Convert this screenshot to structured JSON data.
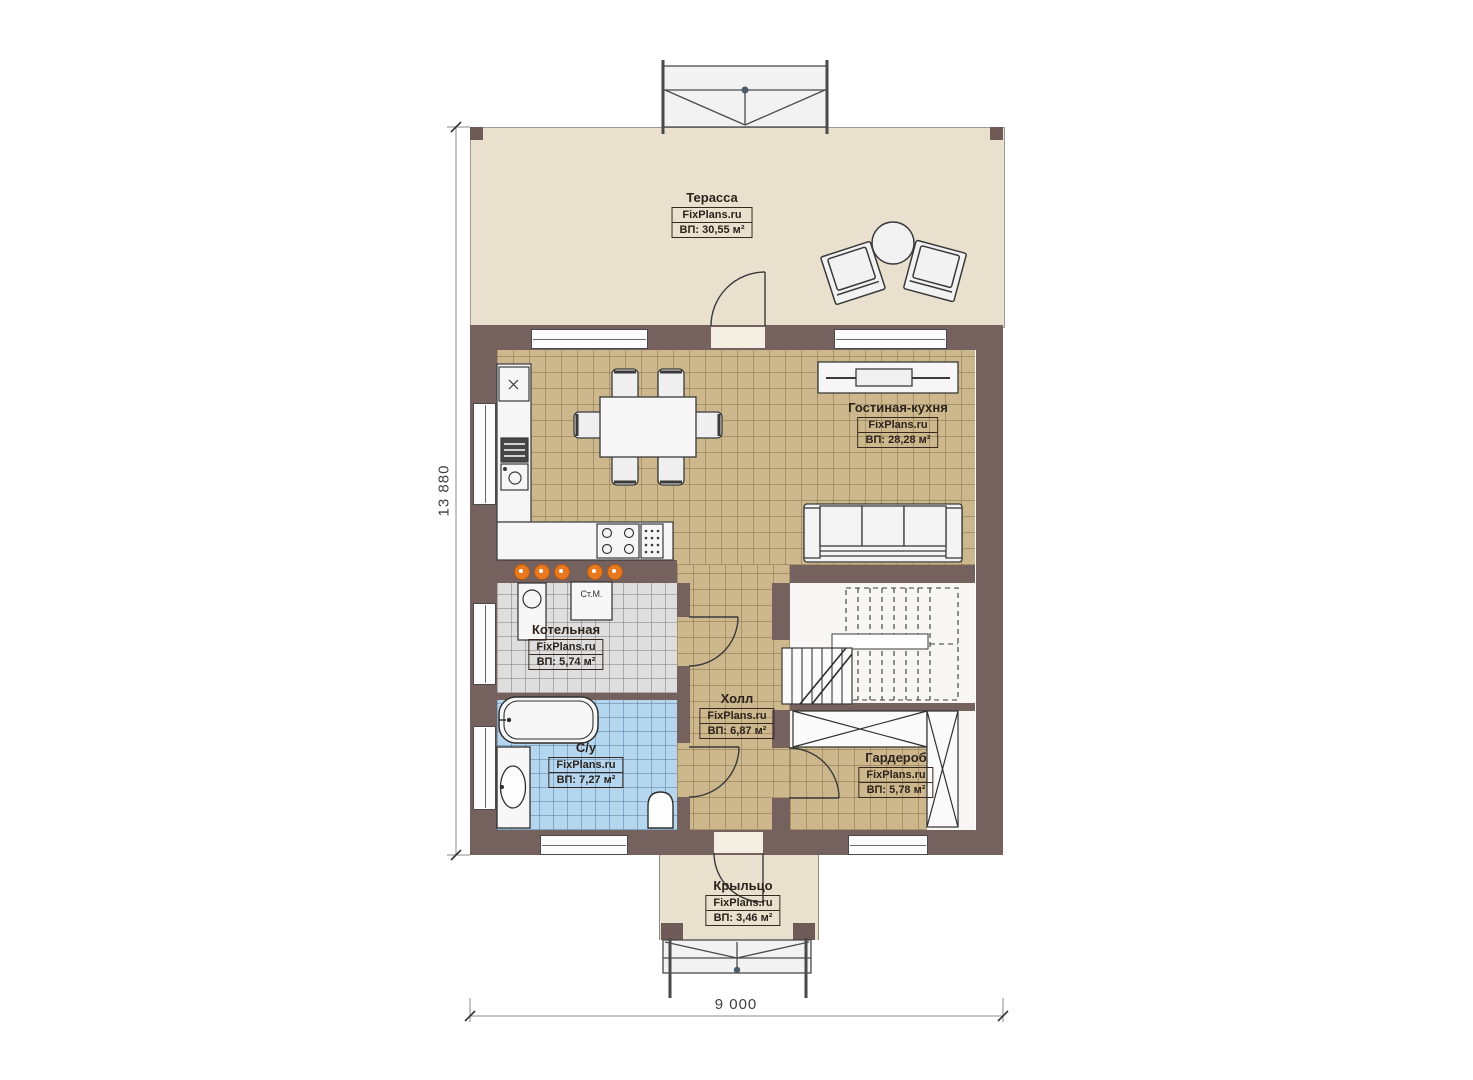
{
  "plan": {
    "brand": "FixPlans.ru",
    "rooms": [
      {
        "id": "terrace",
        "name": "Терасса",
        "brand": "FixPlans.ru",
        "area": "ВП: 30,55 м²"
      },
      {
        "id": "living-kitchen",
        "name": "Гостиная-кухня",
        "brand": "FixPlans.ru",
        "area": "ВП: 28,28 м²"
      },
      {
        "id": "boiler",
        "name": "Котельная",
        "brand": "FixPlans.ru",
        "area": "ВП: 5,74 м²"
      },
      {
        "id": "hall",
        "name": "Холл",
        "brand": "FixPlans.ru",
        "area": "ВП: 6,87 м²"
      },
      {
        "id": "bathroom",
        "name": "С/у",
        "brand": "FixPlans.ru",
        "area": "ВП: 7,27 м²"
      },
      {
        "id": "wardrobe",
        "name": "Гардероб",
        "brand": "FixPlans.ru",
        "area": "ВП: 5,78 м²"
      },
      {
        "id": "porch",
        "name": "Крыльцо",
        "brand": "FixPlans.ru",
        "area": "ВП: 3,46 м²"
      }
    ],
    "dimensions": {
      "vertical": "13 880",
      "horizontal": "9 000"
    },
    "labels": {
      "washing_machine": "Ст.М."
    },
    "colors": {
      "wall": "#75615e",
      "terrace_floor": "#e9e0cd",
      "wood_floor": "#cdb88e",
      "boiler_floor": "#dedede",
      "bathroom_floor": "#b5d6ef",
      "downlight_accent": "#e8791f"
    }
  }
}
